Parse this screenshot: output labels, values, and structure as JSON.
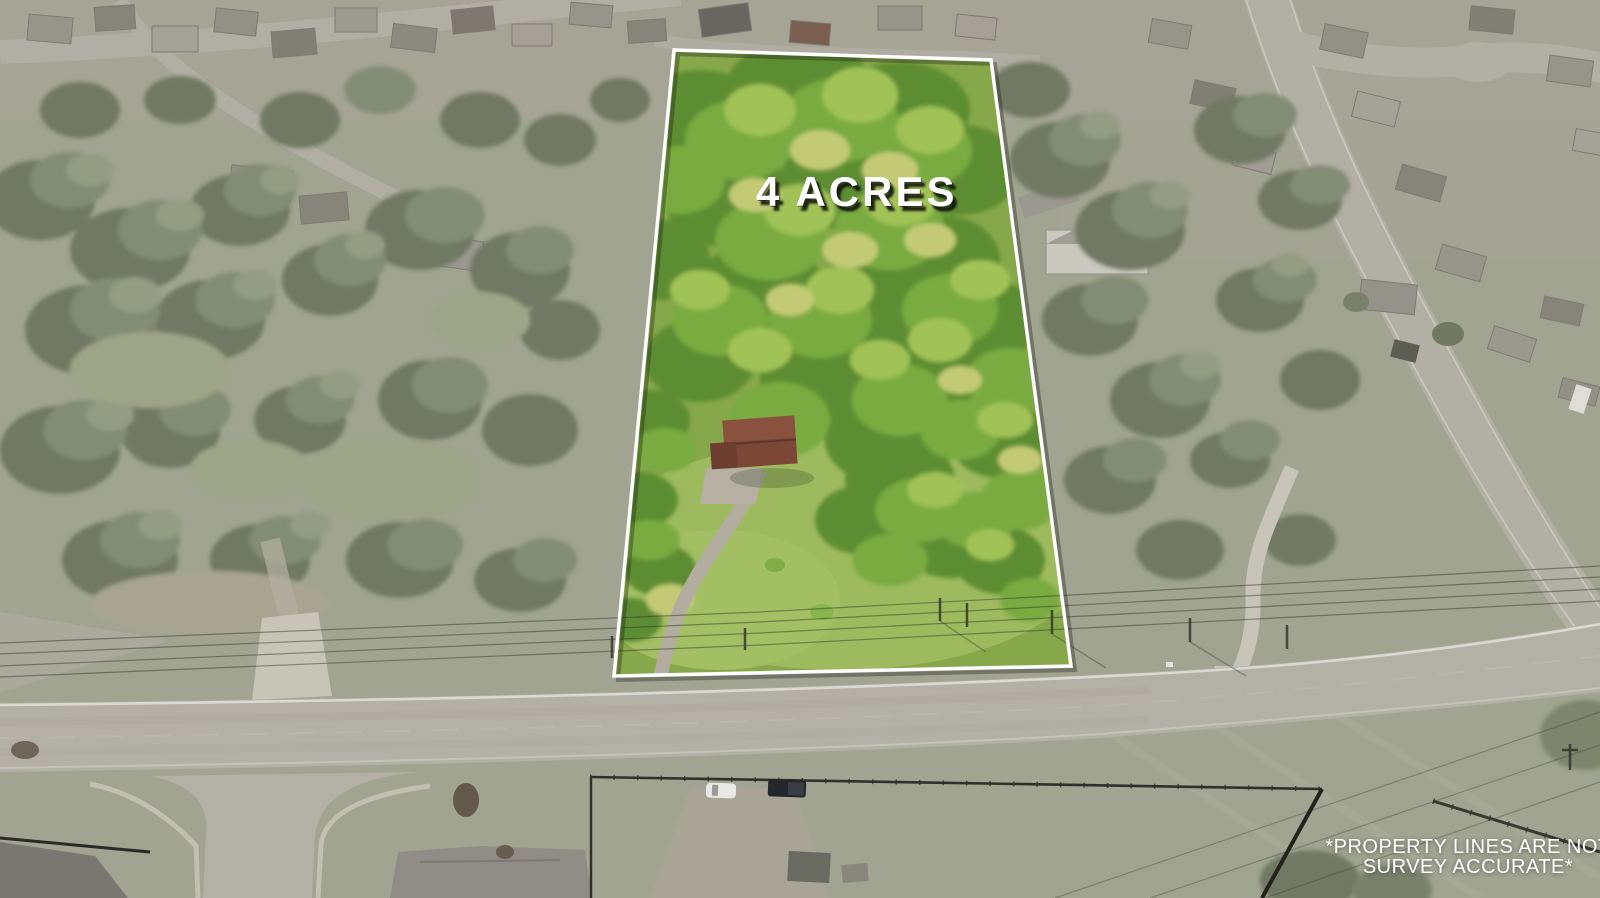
{
  "overlay": {
    "acreage_label": "4 ACRES",
    "disclaimer_line1": "*PROPERTY LINES ARE NOT",
    "disclaimer_line2": "SURVEY ACCURATE*",
    "text_color": "#ffffff"
  },
  "property": {
    "boundary_points": "674,50 991,60 1071,666 614,676",
    "boundary_color": "#ffffff",
    "interior_base_color": "#86a84a",
    "lawn_color": "#9dbb5e"
  },
  "palette": {
    "muted_ground": "#9aa18b",
    "muted_foliage": "#5f6a52",
    "road": "#b2afa7",
    "concrete": "#cbc8bd",
    "fence": "#322f28"
  }
}
